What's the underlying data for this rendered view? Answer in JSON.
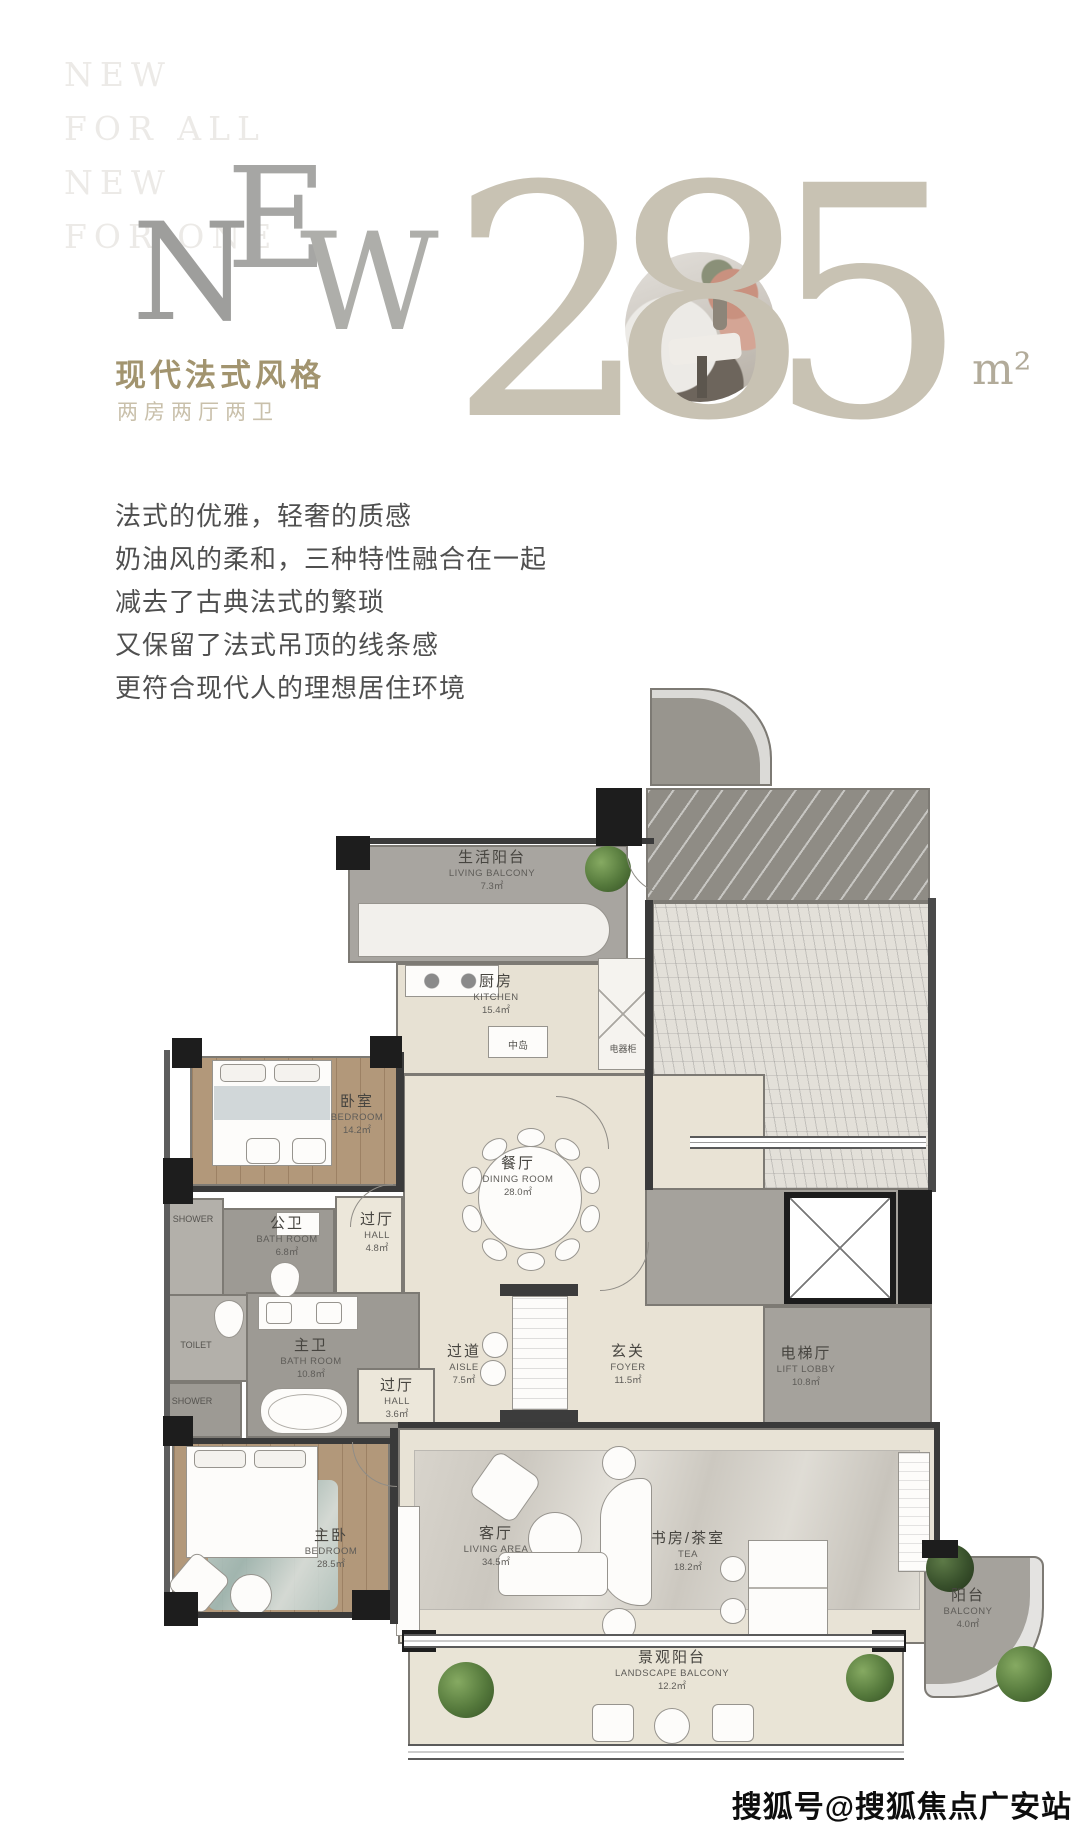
{
  "header": {
    "ghost_lines": [
      "NEW",
      "FOR ALL",
      "NEW",
      "FOR ONE"
    ],
    "big_letters": [
      "N",
      "E",
      "W"
    ],
    "title": "现代法式风格",
    "subtitle": "两房两厅两卫",
    "area_value": "285",
    "area_unit": "m²"
  },
  "intro": {
    "lines": [
      "法式的优雅，轻奢的质感",
      "奶油风的柔和，三种特性融合在一起",
      "减去了古典法式的繁琐",
      "又保留了法式吊顶的线条感",
      "更符合现代人的理想居住环境"
    ]
  },
  "floorplan": {
    "rooms": [
      {
        "id": "living-balcony",
        "cn": "生活阳台",
        "en": "LIVING BALCONY",
        "area": "7.3㎡"
      },
      {
        "id": "kitchen",
        "cn": "厨房",
        "en": "KITCHEN",
        "area": "15.4㎡"
      },
      {
        "id": "bedroom",
        "cn": "卧室",
        "en": "BEDROOM",
        "area": "14.2㎡"
      },
      {
        "id": "hall-upper",
        "cn": "过厅",
        "en": "HALL",
        "area": "4.8㎡"
      },
      {
        "id": "public-bath",
        "cn": "公卫",
        "en": "BATH ROOM",
        "area": "6.8㎡"
      },
      {
        "id": "master-bath",
        "cn": "主卫",
        "en": "BATH ROOM",
        "area": "10.8㎡"
      },
      {
        "id": "hall-lower",
        "cn": "过厅",
        "en": "HALL",
        "area": "3.6㎡"
      },
      {
        "id": "dining",
        "cn": "餐厅",
        "en": "DINING ROOM",
        "area": "28.0㎡"
      },
      {
        "id": "aisle",
        "cn": "过道",
        "en": "AISLE",
        "area": "7.5㎡"
      },
      {
        "id": "foyer",
        "cn": "玄关",
        "en": "FOYER",
        "area": "11.5㎡"
      },
      {
        "id": "lift-lobby",
        "cn": "电梯厅",
        "en": "LIFT LOBBY",
        "area": "10.8㎡"
      },
      {
        "id": "master-bedroom",
        "cn": "主卧",
        "en": "BEDROOM",
        "area": "28.5㎡"
      },
      {
        "id": "living-area",
        "cn": "客厅",
        "en": "LIVING AREA",
        "area": "34.5㎡"
      },
      {
        "id": "study",
        "cn": "书房/茶室",
        "en": "TEA",
        "area": "18.2㎡"
      },
      {
        "id": "landscape-balcony",
        "cn": "景观阳台",
        "en": "LANDSCAPE BALCONY",
        "area": "12.2㎡"
      },
      {
        "id": "balcony",
        "cn": "阳台",
        "en": "BALCONY",
        "area": "4.0㎡"
      }
    ],
    "fixtures": {
      "island": "中岛",
      "appliance_cabinet": "电器柜",
      "shower_1": "SHOWER",
      "toilet": "TOILET",
      "shower_2": "SHOWER"
    }
  },
  "watermark": "搜狐号@搜狐焦点广安站",
  "colors": {
    "accent_gold": "#a2946f",
    "digit_beige": "#c8c2b3",
    "wood_floor": "#b2987a",
    "tile_gray": "#9d9a94",
    "floor_beige": "#e9e3d5"
  }
}
